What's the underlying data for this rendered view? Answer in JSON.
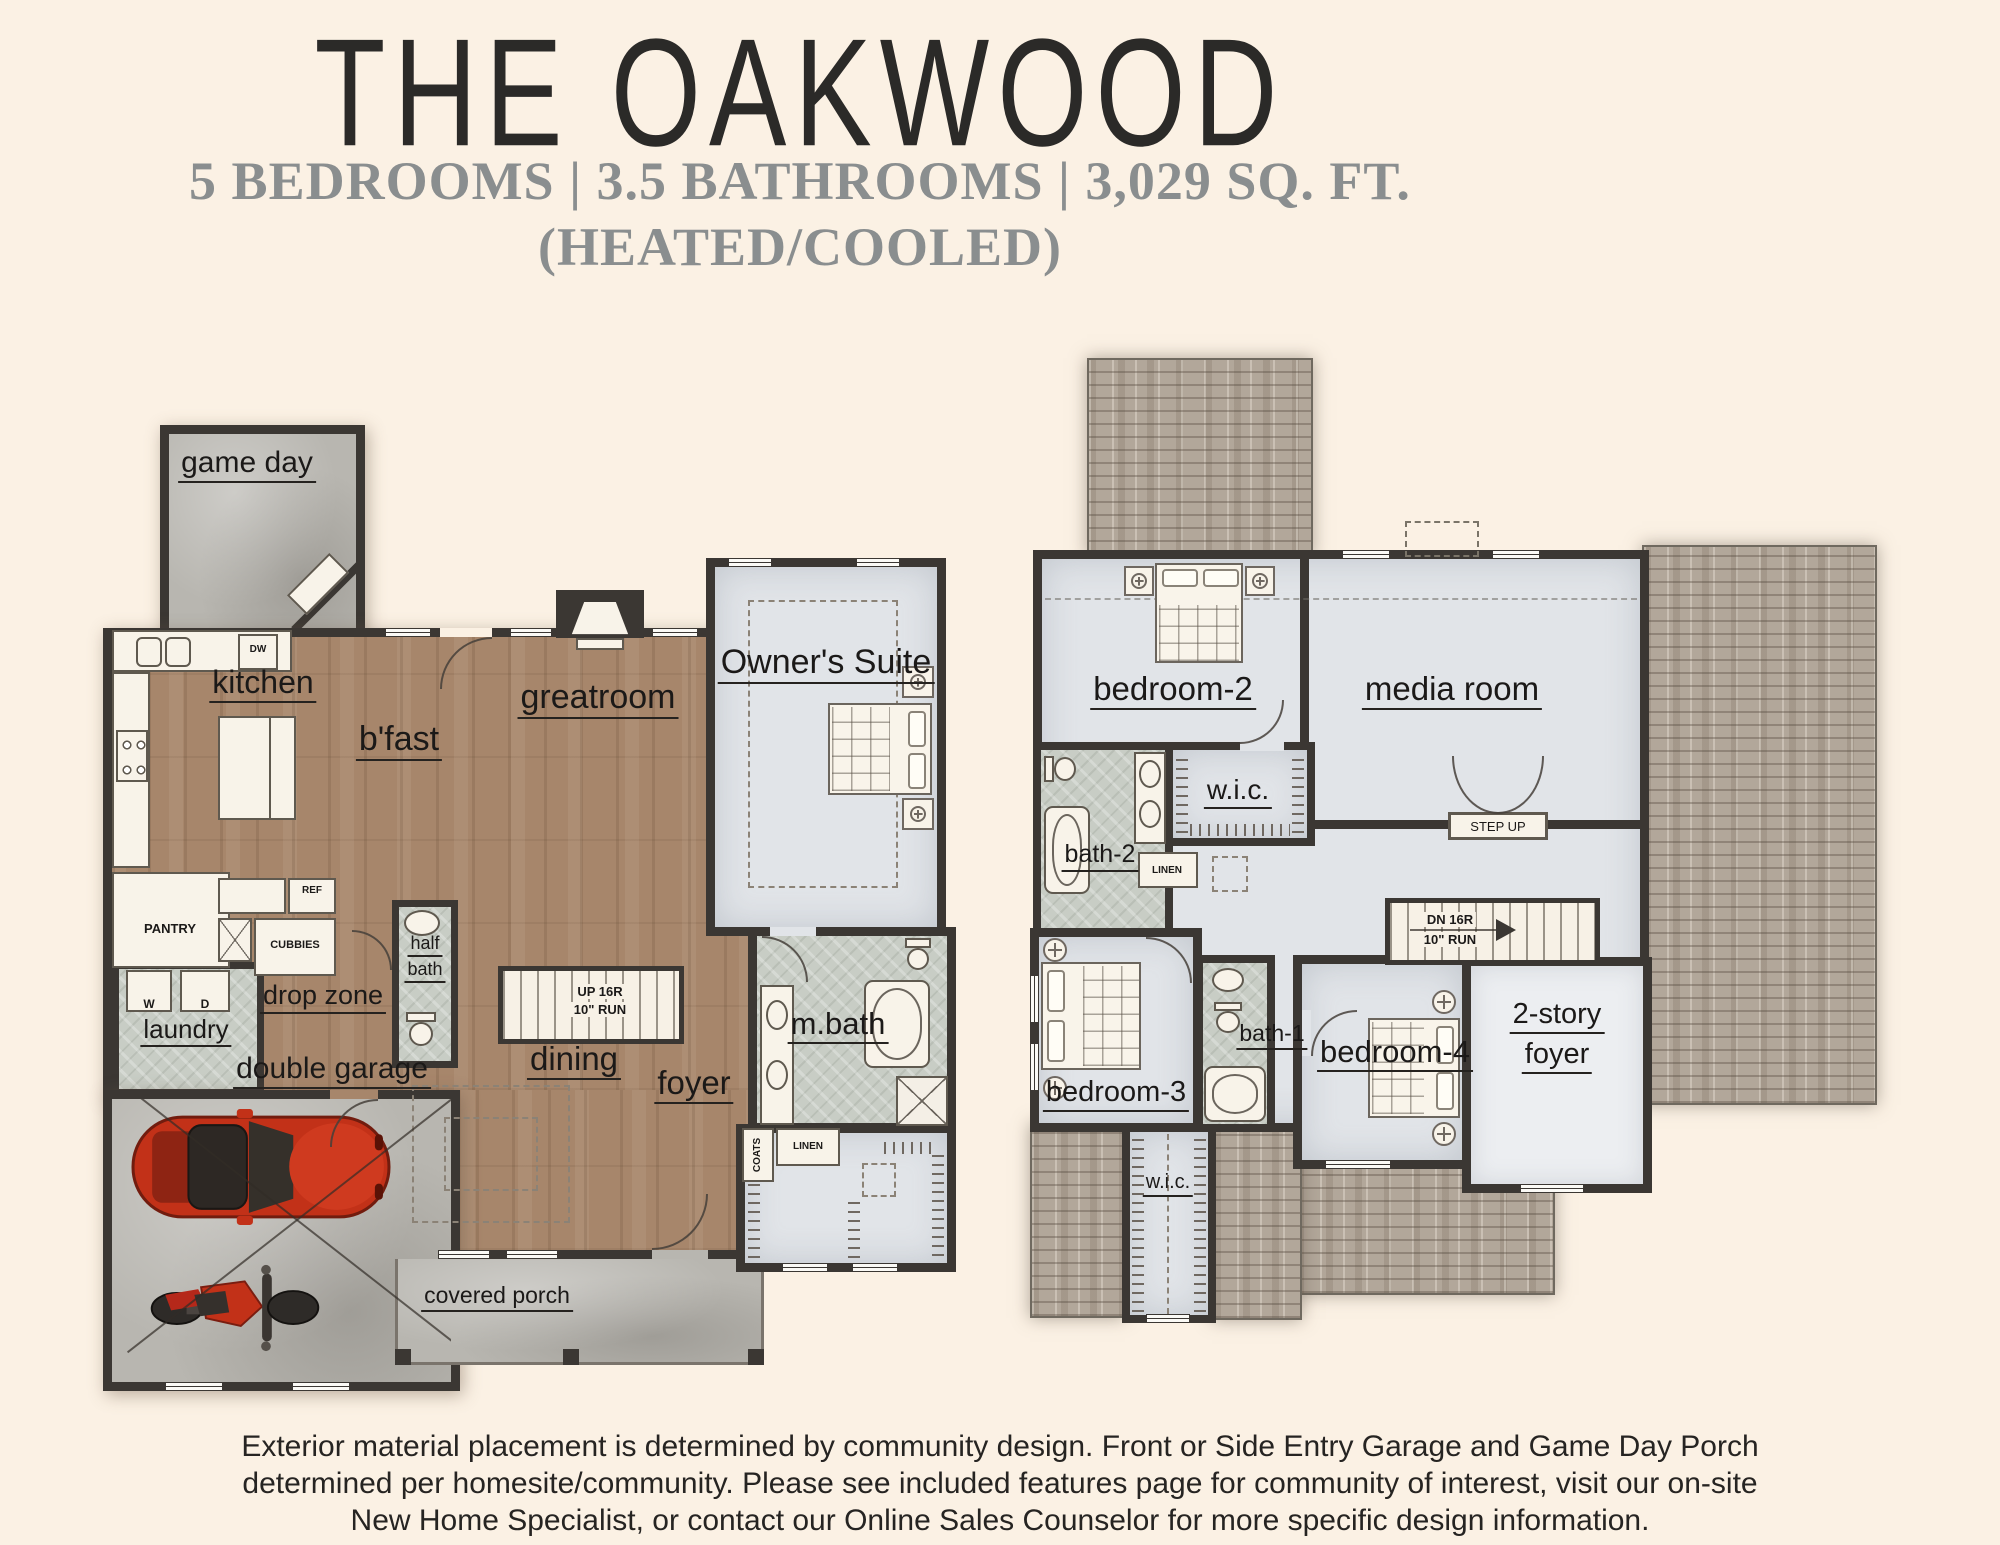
{
  "header": {
    "title": "THE OAKWOOD",
    "subtitle": "5 BEDROOMS | 3.5 BATHROOMS | 3,029 SQ. FT.",
    "subtitle2": "(HEATED/COOLED)"
  },
  "ff": {
    "game_day": "game day",
    "kitchen": "kitchen",
    "bfast": "b'fast",
    "greatroom": "greatroom",
    "owners_suite": "Owner's Suite",
    "pantry": "PANTRY",
    "ref": "REF",
    "dw": "DW",
    "cubbies": "CUBBIES",
    "washer": "W",
    "dryer": "D",
    "laundry": "laundry",
    "drop_zone": "drop zone",
    "half_bath_l1": "half",
    "half_bath_l2": "bath",
    "double_garage": "double garage",
    "dining": "dining",
    "foyer": "foyer",
    "mbath": "m.bath",
    "coats": "COATS",
    "linen": "LINEN",
    "stairs_l1": "UP 16R",
    "stairs_l2": "10\" RUN",
    "covered_porch": "covered porch"
  },
  "sf": {
    "bedroom2": "bedroom-2",
    "media_room": "media room",
    "wic": "w.i.c.",
    "bath2": "bath-2",
    "linen": "LINEN",
    "step_up": "STEP UP",
    "stairs_l1": "DN 16R",
    "stairs_l2": "10\" RUN",
    "bedroom3": "bedroom-3",
    "bath1": "bath-1",
    "bedroom4": "bedroom-4",
    "two_story_l1": "2-story",
    "two_story_l2": "foyer",
    "wic_lower": "w.i.c."
  },
  "disclaimer": {
    "line1": "Exterior material placement is determined by community design. Front or Side Entry Garage and Game Day Porch",
    "line2": "determined per homesite/community. Please see included features page for community of interest, visit our on-site",
    "line3": "New Home Specialist, or contact our Online Sales Counselor for more specific design information."
  },
  "colors": {
    "background": "#fbf1e4",
    "wall": "#3b3733",
    "wood_floor": "#a7866b",
    "concrete": "#b8b6b0",
    "bath_tile": "#c8cdc5",
    "upper_floor": "#e1e4e8",
    "roof_shingle": "#b2a79a",
    "car_red": "#c23118",
    "subtitle_gray": "#8a8e8f",
    "title_dark": "#2b2a28"
  }
}
